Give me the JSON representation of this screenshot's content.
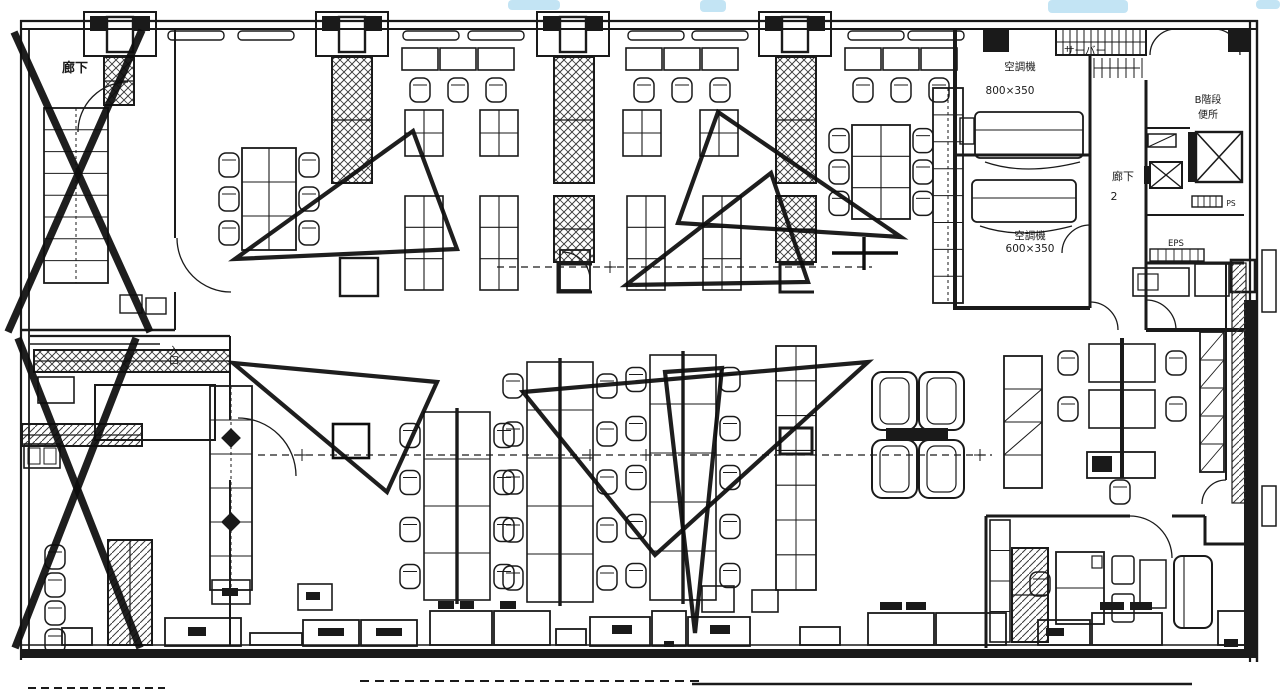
{
  "document": {
    "kind": "scanned architectural office floor plan",
    "style": "black ink line drawing on white paper with hand-drawn markup"
  },
  "colors": {
    "paper": "#ffffff",
    "ink": "#1a1a1a",
    "soft": "#333333",
    "markup": "#0d0d0d",
    "highlight_cyan": "#b9dff2"
  },
  "labels": {
    "corridor_top_left": "廊下",
    "server_room": "サーバー",
    "hvac_room_upper_name": "空調機",
    "hvac_room_upper_size": "800×350",
    "hvac_room_lower_name": "空調機",
    "hvac_room_lower_size": "600×350",
    "corridor_2_name": "廊下",
    "corridor_2_number": "2",
    "stairs_b": "B階段",
    "toilet": "便所",
    "pipe_shaft": "PS",
    "electrical_shaft": "EPS",
    "entrance": "入口"
  },
  "annotations": {
    "x_marks": [
      "upper-left room crossed out",
      "lower-left room crossed out"
    ],
    "triangle_marks_count": 6,
    "plus_mark": "reference cross right of center",
    "highlighter_smudges": [
      "top center-left",
      "top center",
      "top right",
      "top far-right corner"
    ]
  }
}
